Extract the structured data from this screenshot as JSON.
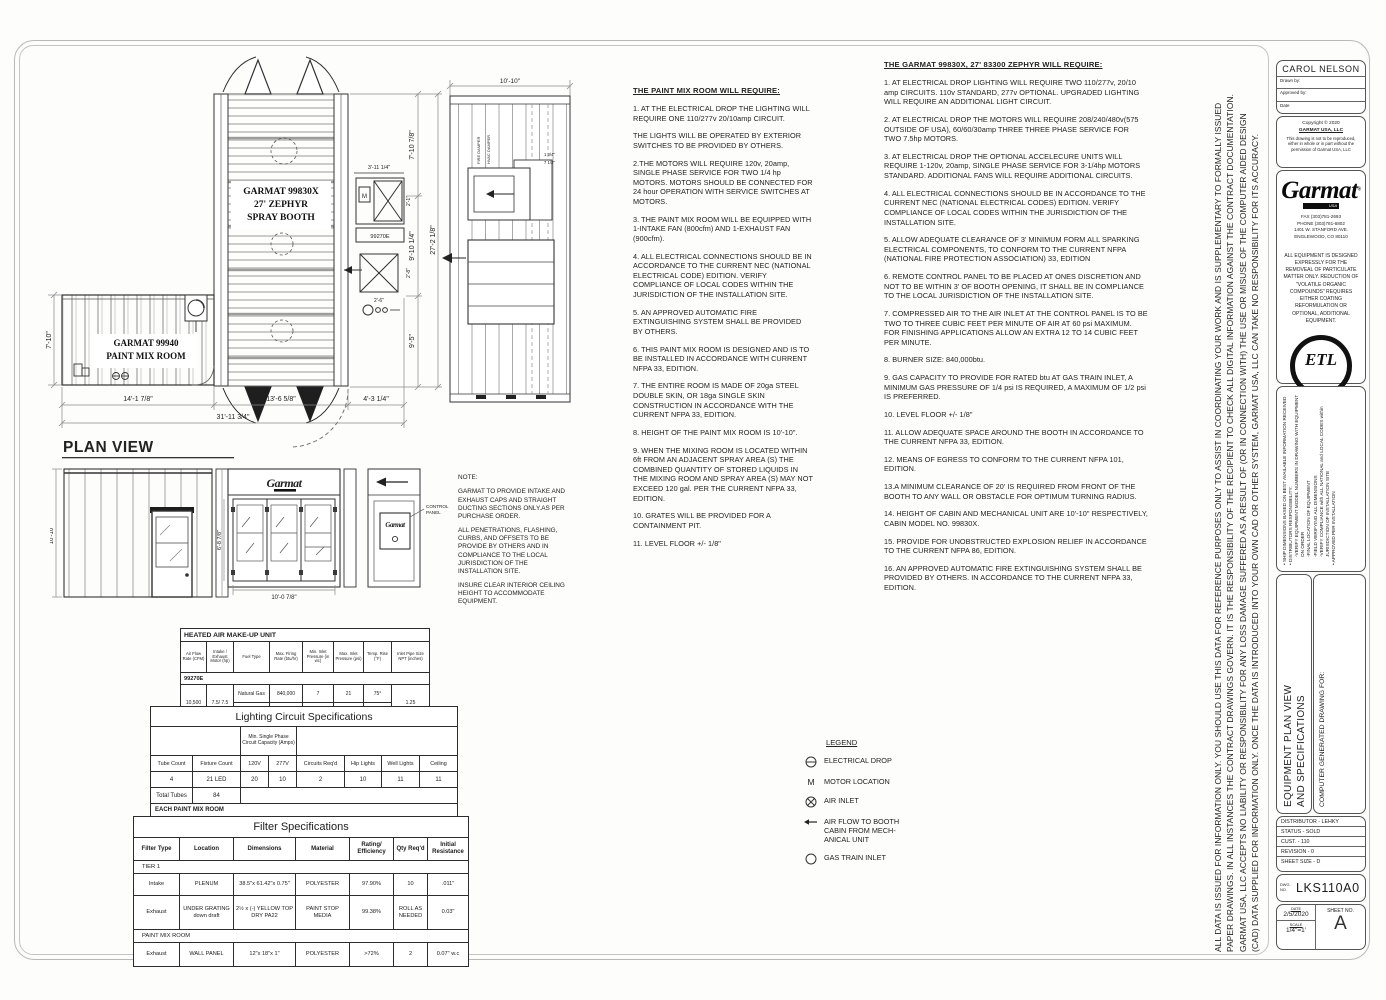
{
  "plan": {
    "title": "PLAN VIEW",
    "booth_line1": "GARMAT 99830X",
    "booth_line2": "27' ZEPHYR",
    "booth_line3": "SPRAY BOOTH",
    "mix_line1": "GARMAT 99940",
    "mix_line2": "PAINT MIX ROOM",
    "mech_model": "99270E",
    "dim_right_seg1": "7'-10 7/8\"",
    "dim_right_seg2": "9'-10 1/4\"",
    "dim_right_seg3": "9'-5\"",
    "dim_right_total": "27'-2 1/8\"",
    "dim_left": "7'-10\"",
    "dim_mech_w": "3'-11 1/4\"",
    "dim_mech_1": "2'-1\"",
    "dim_mech_2": "2'-8\"",
    "dim_mech_3": "2'-6\"",
    "dim_bottom_1": "14'-1 7/8\"",
    "dim_bottom_2": "13'-6 5/8\"",
    "dim_bottom_3": "4'-3 1/4\"",
    "dim_bottom_total": "31'-11 3/4\""
  },
  "section": {
    "dim_top": "10'-10\"",
    "dim_a": "1 3/4\"",
    "dim_b": "7 1/2\"",
    "label_fire": "FIRE DAMPER",
    "label_hvac": "HVAC DAMPER"
  },
  "elevation": {
    "dim_left": "10'-10\"",
    "dim_door_h": "6'-8 7/8\"",
    "dim_door_w": "10'-0 7/8\"",
    "logo_text": "Garmat",
    "control_label_1": "CONTROL",
    "control_label_2": "PANEL"
  },
  "note": {
    "heading": "NOTE:",
    "p1": "GARMAT TO PROVIDE INTAKE AND EXHAUST CAPS AND STRAIGHT DUCTING SECTIONS ONLY.AS PER PURCHASE ORDER.",
    "p2": "ALL PENETRATIONS, FLASHING, CURBS, AND OFFSETS TO BE PROVIDE BY OTHERS AND IN COMPLIANCE TO THE LOCAL JURISDICTION OF THE INSTALLATION SITE.",
    "p3": "INSURE CLEAR INTERIOR CEILING HEIGHT TO ACCOMMODATE EQUIPMENT."
  },
  "left_notes": {
    "title": "THE PAINT MIX ROOM WILL REQUIRE:",
    "paragraphs": [
      "1.   AT THE ELECTRICAL DROP THE LIGHTING WILL REQUIRE ONE 110/277v 20/10amp CIRCUIT.",
      "THE LIGHTS WILL BE OPERATED BY EXTERIOR SWITCHES TO BE PROVIDED BY OTHERS.",
      "2.THE MOTORS WILL REQUIRE 120v, 20amp, SINGLE PHASE SERVICE FOR TWO 1/4 hp MOTORS. MOTORS SHOULD BE CONNECTED FOR 24 hour OPERATION WITH SERVICE SWITCHES AT MOTORS.",
      "3.   THE PAINT MIX ROOM WILL BE EQUIPPED WITH 1-INTAKE FAN (800cfm) AND 1-EXHAUST FAN (900cfm).",
      "4.   ALL ELECTRICAL CONNECTIONS SHOULD BE IN ACCORDANCE TO THE CURRENT NEC (NATIONAL ELECTRICAL CODE) EDITION. VERIFY COMPLIANCE OF LOCAL CODES WITHIN THE JURISDICTION OF THE INSTALLATION SITE.",
      "5.   AN APPROVED AUTOMATIC FIRE EXTINGUISHING SYSTEM SHALL BE PROVIDED BY OTHERS.",
      "6.   THIS PAINT MIX ROOM IS DESIGNED AND IS TO BE INSTALLED IN ACCORDANCE WITH CURRENT NFPA 33, EDITION.",
      "7.   THE ENTIRE ROOM IS MADE OF 20ga STEEL DOUBLE SKIN, OR 18ga SINGLE SKIN CONSTRUCTION IN ACCORDANCE WITH THE CURRENT NFPA 33, EDITION.",
      "8.   HEIGHT OF THE PAINT MIX ROOM IS 10'-10\".",
      "9.   WHEN THE MIXING ROOM IS LOCATED WITHIN 6ft FROM AN ADJACENT SPRAY AREA (S) THE COMBINED QUANTITY OF STORED LIQUIDS IN THE MIXING ROOM AND SPRAY AREA (S) MAY NOT EXCEED 120 gal. PER THE CURRENT NFPA 33, EDITION.",
      "10. GRATES WILL BE PROVIDED FOR A CONTAINMENT PIT.",
      "11. LEVEL FLOOR +/- 1/8\""
    ]
  },
  "right_notes": {
    "title": "THE GARMAT 99830X, 27' 83300 ZEPHYR WILL REQUIRE:",
    "paragraphs": [
      "1. AT ELECTRICAL DROP LIGHTING WILL REQUIRE TWO 110/277v, 20/10 amp CIRCUITS. 110v STANDARD, 277v OPTIONAL. UPGRADED LIGHTING WILL REQUIRE AN ADDITIONAL LIGHT CIRCUIT.",
      "2. AT ELECTRICAL DROP THE MOTORS WILL REQUIRE 208/240/480v(575 OUTSIDE OF USA), 60/60/30amp THREE THREE PHASE SERVICE FOR TWO 7.5hp MOTORS.",
      "3. AT ELECTRICAL DROP THE OPTIONAL ACCELECURE UNITS WILL REQUIRE 1-120v, 20amp, SINGLE PHASE SERVICE FOR 3-1/4hp MOTORS STANDARD. ADDITIONAL FANS WILL REQUIRE ADDITIONAL CIRCUITS.",
      "4. ALL ELECTRICAL CONNECTIONS SHOULD BE IN ACCORDANCE TO THE CURRENT NEC (NATIONAL ELECTRICAL CODES) EDITION. VERIFY COMPLIANCE OF LOCAL CODES WITHIN THE JURISDICTION OF THE INSTALLATION SITE.",
      "5. ALLOW ADEQUATE CLEARANCE OF 3' MINIMUM FORM ALL SPARKING ELECTRICAL COMPONENTS, TO CONFORM TO THE CURRENT NFPA (NATIONAL FIRE PROTECTION ASSOCIATION) 33, EDITION",
      "6. REMOTE CONTROL PANEL TO BE PLACED AT ONES DISCRETION AND NOT TO BE WITHIN 3' OF BOOTH OPENING, IT SHALL BE IN COMPLIANCE TO THE LOCAL JURISDICTION OF THE INSTALLATION SITE.",
      "7. COMPRESSED AIR TO THE AIR INLET AT THE CONTROL PANEL IS TO BE TWO TO THREE CUBIC FEET PER MINUTE OF AIR AT 60 psi MAXIMUM. FOR FINISHING APPLICATIONS ALLOW AN EXTRA 12 TO 14 CUBIC FEET PER MINUTE.",
      "8. BURNER SIZE:  840,000btu.",
      "9. GAS CAPACITY TO PROVIDE FOR RATED btu AT GAS TRAIN INLET, A MINIMUM GAS PRESSURE OF 1/4 psi IS REQUIRED, A MAXIMUM OF 1/2 psi IS PREFERRED.",
      "10. LEVEL FLOOR +/- 1/8\"",
      "11. ALLOW ADEQUATE SPACE AROUND THE BOOTH IN ACCORDANCE TO THE CURRENT NFPA 33, EDITION.",
      "12. MEANS OF EGRESS TO CONFORM TO THE  CURRENT NFPA 101, EDITION.",
      "13.A MINIMUM CLEARANCE OF 20' IS REQUIRED FROM FRONT OF THE BOOTH TO ANY WALL OR OBSTACLE FOR OPTIMUM TURNING RADIUS.",
      "14. HEIGHT OF CABIN AND MECHANICAL UNIT ARE 10'-10\" RESPECTIVELY, CABIN MODEL NO. 99830X.",
      "15. PROVIDE FOR UNOBSTRUCTED EXPLOSION RELIEF IN ACCORDANCE TO THE CURRENT NFPA 86, EDITION.",
      "16. AN APPROVED AUTOMATIC FIRE EXTINGUISHING SYSTEM SHALL BE PROVIDED BY OTHERS. IN ACCORDANCE TO THE CURRENT NFPA 33, EDITION."
    ]
  },
  "legend": {
    "title": "LEGEND",
    "items": [
      {
        "symbol": "electrical-drop",
        "label": "ELECTRICAL DROP"
      },
      {
        "symbol": "motor",
        "label": "MOTOR LOCATION",
        "glyph": "M"
      },
      {
        "symbol": "air-inlet",
        "label": "AIR INLET"
      },
      {
        "symbol": "air-flow-arrow",
        "label": "AIR FLOW TO BOOTH CABIN FROM MECH-ANICAL UNIT"
      },
      {
        "symbol": "gas-train-inlet",
        "label": "GAS TRAIN INLET"
      }
    ]
  },
  "heated_table": {
    "title": "HEATED AIR MAKE-UP UNIT",
    "headers": [
      "Air Flow Rate (CFM)",
      "Intake / Exhaust Motor (hp)",
      "Fuel Type",
      "Max. Firing Rate (btu/hr)",
      "Min. Inlet Pressure (in wc)",
      "Max. Inlet Pressure (psi)",
      "Temp. Rise (°F)",
      "Inlet Pipe Size NPT (inches)"
    ],
    "model": "99270E",
    "shared": {
      "airflow": "10,500",
      "motor": "7.5/ 7.5",
      "pipe": "1.25"
    },
    "fuel_rows": [
      [
        "Natural Gas",
        "840,000",
        "7",
        "21",
        "75°"
      ],
      [
        "Propane",
        "840,000",
        "5",
        "15",
        "75°"
      ]
    ]
  },
  "lighting_table": {
    "title": "Lighting Circuit Specifications",
    "span_header": "Min. Single Phase Circuit Capacity (Amps)",
    "columns": [
      "Tube Count",
      "Fixture Count",
      "120V",
      "277V",
      "Circuits Req'd",
      "Hip Lights",
      "Well Lights",
      "Ceiling"
    ],
    "row1": [
      "4",
      "21 LED",
      "20",
      "10",
      "2",
      "10",
      "11",
      "11"
    ],
    "total_label": "Total Tubes",
    "total_value": "84",
    "section2": "EACH PAINT MIX ROOM",
    "row2": [
      "4",
      "3",
      "20",
      "10",
      "1",
      "-",
      "-",
      "3"
    ],
    "total2_label": "Total Tubes",
    "total2_value": "12"
  },
  "filter_table": {
    "title": "Filter Specifications",
    "columns": [
      "Filter Type",
      "Location",
      "Dimensions",
      "Material",
      "Rating/ Efficiency",
      "Qty Req'd",
      "Initial Resistance"
    ],
    "section1": "TIER 1",
    "rows1": [
      [
        "Intake",
        "PLENUM",
        "38.5\"x 61.42\"x 0.75\"",
        "POLYESTER",
        "97.90%",
        "10",
        ".011\""
      ],
      [
        "Exhaust",
        "UNDER GRATING down draft",
        "2½ x (-) YELLOW TOP DRY PA22",
        "PAINT STOP MEDIA",
        "99.38%",
        "ROLL AS NEEDED",
        "0.03\""
      ]
    ],
    "section2": "PAINT MIX ROOM",
    "rows2": [
      [
        "Exhaust",
        "WALL PANEL",
        "12\"x 18\"x 1\"",
        "POLYESTER",
        ">72%",
        "2",
        "0.07\" w.c"
      ]
    ]
  },
  "disclaimer": {
    "lines": [
      "ALL DATA IS ISSUED FOR INFORMATION ONLY. YOU SHOULD USE THIS DATA FOR REFERENCE PURPOSES ONLY TO ASSIST IN COORDINATING YOUR WORK AND IS SUPPLEMENTARY TO FORMALLY ISSUED",
      "PAPER DRAWINGS. IN ALL INSTANCES THE CONTRACT DRAWINGS GOVERN. IT IS THE RESPONSIBILITY OF THE RECIPIENT TO CHECK ALL DIGITAL INFORMATION AGAINST THE CONTRACT DOCUMENTATION.",
      "GARMAT USA, LLC ACCEPTS NO LIABILITY OR RESPONSIBILITY FOR ANY LOSS DAMAGE SUFFERED AS A RESULT OF (OR IN CONNECTION WITH) THE USE OR MISUSE OF THE COMPUTER AIDED DESIGN",
      "(CAD) DATA SUPPLIED FOR INFORMATION ONLY. ONCE THE DATA IS INTRODUCED INTO YOUR OWN CAD OR OTHER SYSTEM, GARMAT USA, LLC CAN TAKE NO RESPONSIBILITY FOR ITS ACCURACY."
    ]
  },
  "titleblock": {
    "drawn_name": "CAROL NELSON",
    "drawn_by_label": "Drawn by:",
    "approved_by_label": "Approved by:",
    "date_label": "Date",
    "copyright_line": "Copyright © 2020",
    "company": "GARMAT USA, LLC",
    "copyright_note": "This drawing is not to be reproduced, either in whole or in part without the permission of Garmat USA, LLC",
    "logo_text": "Garmat",
    "logo_reg": "®",
    "logo_sub": "USA",
    "fax": "FAX (303)781-2693",
    "phone": "PHONE (303)781-6802",
    "address1": "1401 W. STANFORD AVE.",
    "address2": "ENGLEWOOD, CO 80110",
    "equipment_note": "ALL EQUIPMENT IS DESIGNED EXPRESSLY FOR THE REMOVEAL OF PARTICULATE MATTER ONLY. REDUCTION OF \"VOLATILE ORGANIC COMPOUNDS\" REQUIRES EITHER COATING REFORMULATION OR OPTIONAL, ADDITIONAL EQUIPMENT.",
    "etl_word": "ETL",
    "etl_listed": "LISTED",
    "etl_c": "C",
    "etl_us": "US",
    "etl_intertek": "Intertek",
    "ship_notes": [
      "•  SHIP DIMENSIONS BASED ON BEST AVAILABLE INFORMATION RECEIVED",
      "•  DISTRIBUTORS RESPONSIBILITY:",
      "-VERIFY EQUIPMENT MODEL NUMBERS IN DRAWING WITH EQUIPMENT ON ORDER",
      "-FINAL LOCATION OF EQUIPMENT",
      "-FIELD VERIFYING ALL DIMENSIONS",
      "-VERIFY COMPLIANCE with ALL NATIONAL and LOCAL CODES within JURISDICTION OF INSTALLATION SITE",
      "•  APPROVED PER INSTALLATION"
    ],
    "drawing_title_1": "EQUIPMENT PLAN VIEW",
    "drawing_title_2": "AND SPECIFICATIONS",
    "generated_for": "COMPUTER GENERATED DRAWING FOR:",
    "info_rows": [
      "DISTRIBUTOR - LEHKY",
      "STATUS - SOLD",
      "CUST. - 110",
      "REVISION - 0",
      "SHEET SIZE - D"
    ],
    "dwg_label": "DWG. NO.",
    "dwg_no": "LKS110A0",
    "date_field_label": "DATE",
    "date_value": "2/5/2020",
    "scale_label": "SCALE",
    "scale_value": "1/4\"=1'",
    "sheet_label": "SHEET NO.",
    "sheet_value": "A"
  },
  "colors": {
    "ink": "#1c1c1c",
    "line_light": "#8f8f8f",
    "paper": "#fdfdfc"
  }
}
